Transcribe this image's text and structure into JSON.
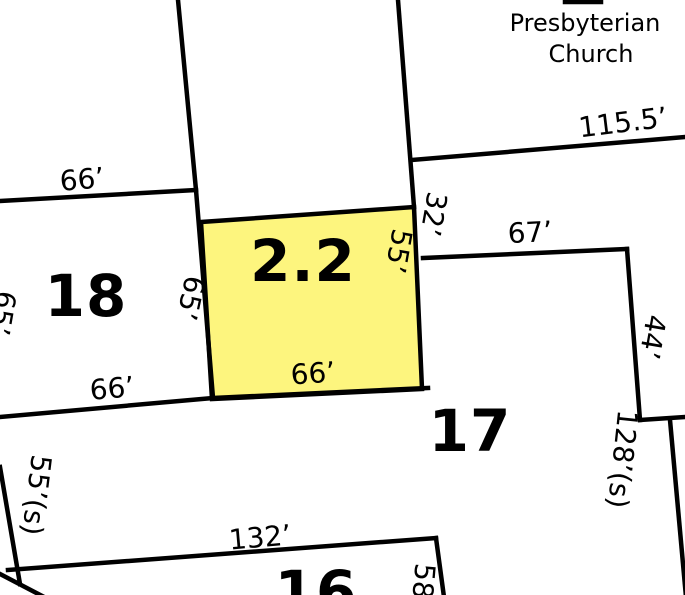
{
  "map": {
    "type": "cadastral-parcel-map",
    "church": {
      "line1": "Presbyterian",
      "line2": "Church"
    },
    "parcels": {
      "p18": "18",
      "p22": "2.2",
      "p17": "17",
      "p16": "16"
    },
    "dimensions": {
      "d66_top": "66’",
      "d66_mid": "66’",
      "d66_yellow": "66’",
      "d115_5": "115.5’",
      "d32": "32’",
      "d67": "67’",
      "d55_yellow": "55’",
      "d65_yellow": "65’",
      "d65_left": "65’",
      "d44": "44’",
      "d128": "128’(s)",
      "d55_s": "55’(s)",
      "d132": "132’",
      "d58": "58"
    },
    "colors": {
      "highlight": "#FDF57E",
      "line": "#000000",
      "background": "#FFFFFF"
    }
  }
}
